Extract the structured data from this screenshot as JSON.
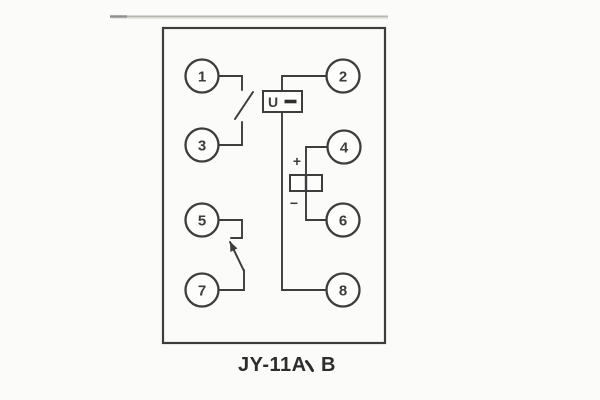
{
  "colors": {
    "ink": "#3d3d3d",
    "rule_gray": "#b4b6b0",
    "background": "#fbfbfa"
  },
  "terminals": [
    "1",
    "2",
    "3",
    "4",
    "5",
    "6",
    "7",
    "8"
  ],
  "coil": {
    "letter": "U",
    "modifier": "-"
  },
  "polarity": {
    "plus": "+",
    "minus": "−"
  },
  "caption": {
    "full": "JY-11A、B",
    "left": "JY-11A",
    "separator": "、",
    "right": "B"
  }
}
